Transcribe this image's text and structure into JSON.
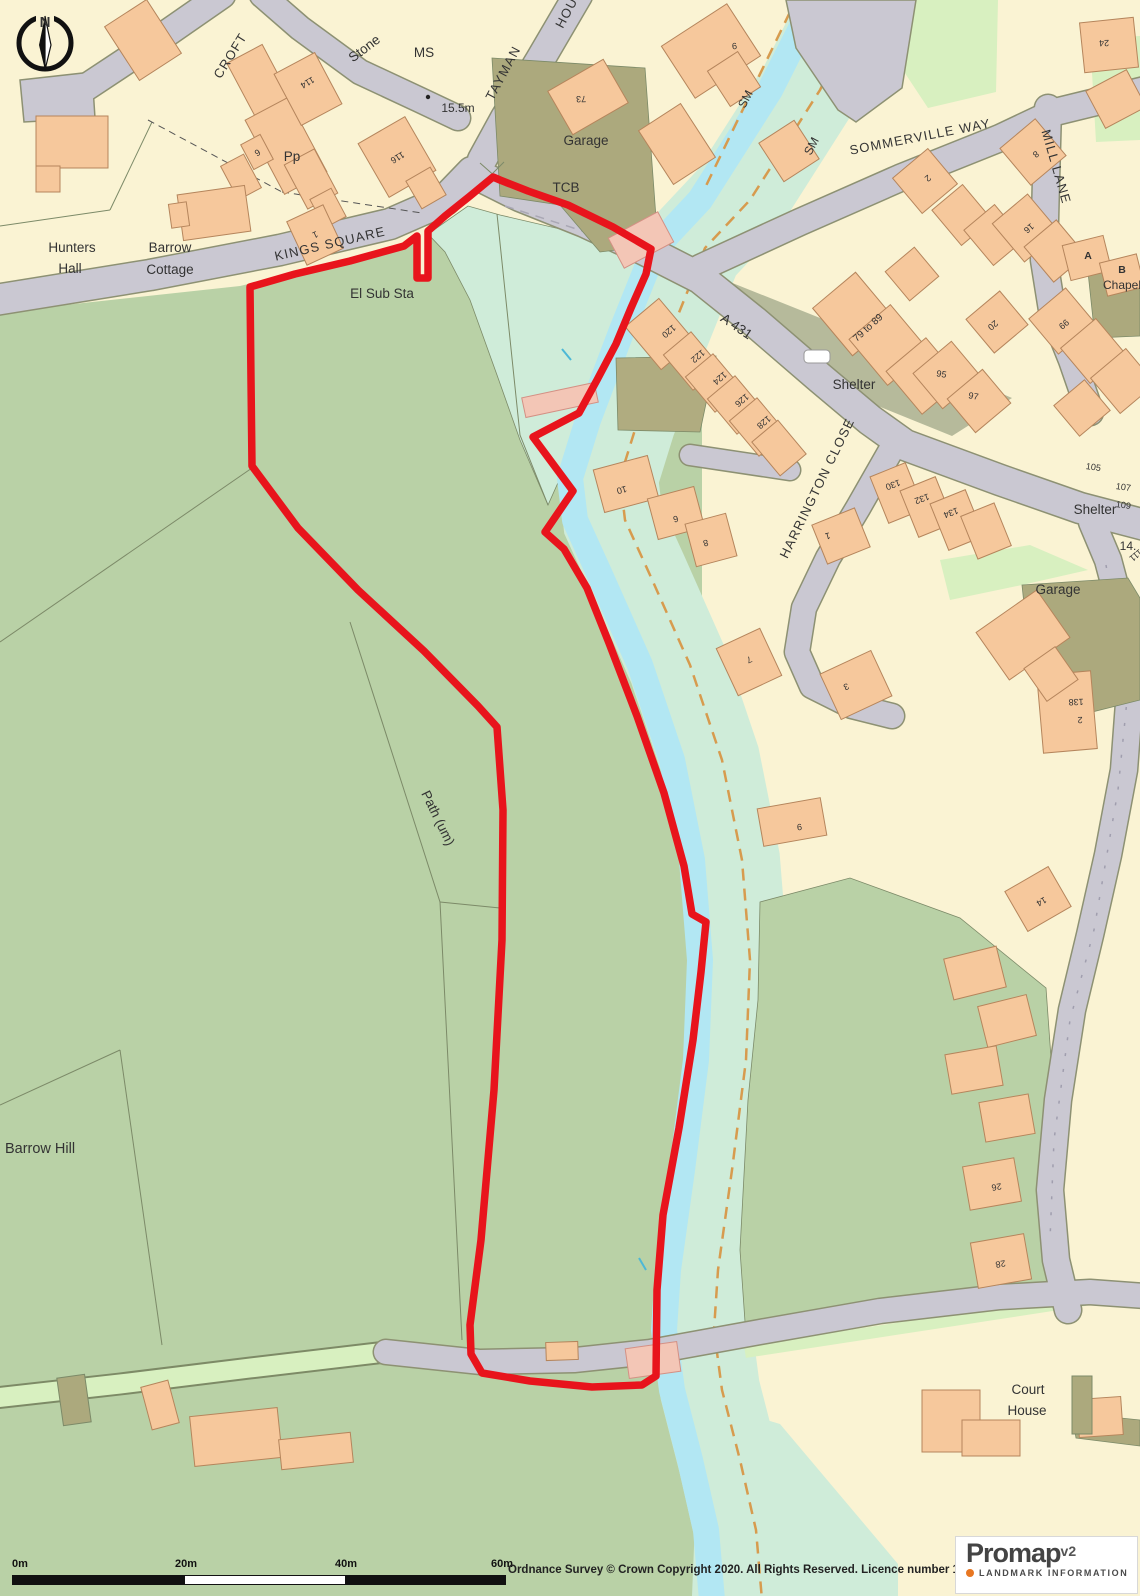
{
  "map": {
    "colors": {
      "cream": "#faf3d3",
      "field": "#b9d1a6",
      "mint": "#cfecd9",
      "verge": "#d8f0c0",
      "stream": "#b2e7f3",
      "road": "#cac8d2",
      "road_casing": "#8d9173",
      "khaki": "#aca97d",
      "khaki2": "#b6ba9b",
      "building": "#f6c89c",
      "building_stroke": "#b5855c",
      "pink": "#f3c6b6",
      "pink_stroke": "#d49084",
      "boundary": "#e8141c",
      "parcel": "#7c8a68",
      "dashed_orange": "#d79b4e",
      "label": "#333333",
      "number": "#444444"
    },
    "labels": [
      {
        "t": "CROFT",
        "x": 234,
        "y": 58,
        "r": -58,
        "c": "road"
      },
      {
        "t": "Stone",
        "x": 367,
        "y": 52,
        "r": -37,
        "c": "place"
      },
      {
        "t": "MS",
        "x": 424,
        "y": 57,
        "r": 0,
        "c": "place"
      },
      {
        "t": "15.5m",
        "x": 458,
        "y": 112,
        "r": 0,
        "c": "place",
        "s": 12
      },
      {
        "t": "TAYMAN",
        "x": 507,
        "y": 75,
        "r": -62,
        "c": "road"
      },
      {
        "t": "HOUSE",
        "x": 575,
        "y": 6,
        "r": -62,
        "c": "road"
      },
      {
        "t": "Garage",
        "x": 586,
        "y": 145,
        "r": 0,
        "c": "place"
      },
      {
        "t": "TCB",
        "x": 566,
        "y": 192,
        "r": 0,
        "c": "place"
      },
      {
        "t": "SM",
        "x": 749,
        "y": 101,
        "r": -62,
        "c": "place",
        "s": 12
      },
      {
        "t": "SM",
        "x": 815,
        "y": 148,
        "r": -62,
        "c": "place",
        "s": 12
      },
      {
        "t": "SOMMERVILLE WAY",
        "x": 921,
        "y": 141,
        "r": -11,
        "c": "road"
      },
      {
        "t": "MILL LANE",
        "x": 1052,
        "y": 168,
        "r": 74,
        "c": "road"
      },
      {
        "t": "KINGS SQUARE",
        "x": 331,
        "y": 248,
        "r": -13,
        "c": "road"
      },
      {
        "t": "Hunters",
        "x": 72,
        "y": 252,
        "r": 0,
        "c": "place"
      },
      {
        "t": "Hall",
        "x": 70,
        "y": 273,
        "r": 0,
        "c": "place"
      },
      {
        "t": "Barrow",
        "x": 170,
        "y": 252,
        "r": 0,
        "c": "place"
      },
      {
        "t": "Cottage",
        "x": 170,
        "y": 274,
        "r": 0,
        "c": "place"
      },
      {
        "t": "Pp",
        "x": 292,
        "y": 161,
        "r": 0,
        "c": "place"
      },
      {
        "t": "El Sub Sta",
        "x": 382,
        "y": 298,
        "r": 0,
        "c": "place"
      },
      {
        "t": "A 431",
        "x": 734,
        "y": 330,
        "r": 34,
        "c": "place"
      },
      {
        "t": "Shelter",
        "x": 854,
        "y": 389,
        "r": 0,
        "c": "place"
      },
      {
        "t": "HARRINGTON CLOSE",
        "x": 821,
        "y": 490,
        "r": -64,
        "c": "road"
      },
      {
        "t": "Shelter",
        "x": 1095,
        "y": 514,
        "r": 0,
        "c": "place"
      },
      {
        "t": "14.",
        "x": 1128,
        "y": 550,
        "r": 0,
        "c": "place",
        "s": 12
      },
      {
        "t": "Garage",
        "x": 1058,
        "y": 594,
        "r": 0,
        "c": "place"
      },
      {
        "t": "Chapel",
        "x": 1122,
        "y": 289,
        "r": 0,
        "c": "place",
        "s": 12
      },
      {
        "t": "Path (um)",
        "x": 434,
        "y": 820,
        "r": 64,
        "c": "place"
      },
      {
        "t": "Barrow Hill",
        "x": 40,
        "y": 1153,
        "r": 0,
        "c": "place",
        "s": 14.5
      },
      {
        "t": "Court",
        "x": 1028,
        "y": 1394,
        "r": 0,
        "c": "place"
      },
      {
        "t": "House",
        "x": 1027,
        "y": 1415,
        "r": 0,
        "c": "place"
      },
      {
        "t": "79 to 89",
        "x": 870,
        "y": 330,
        "r": -42,
        "c": "num",
        "s": 10
      }
    ],
    "house_numbers": [
      {
        "t": "114",
        "x": 306,
        "y": 80,
        "r": 150
      },
      {
        "t": "116",
        "x": 396,
        "y": 155,
        "r": 148
      },
      {
        "t": "6",
        "x": 256,
        "y": 150,
        "r": 150
      },
      {
        "t": "1",
        "x": 314,
        "y": 232,
        "r": 155
      },
      {
        "t": "73",
        "x": 581,
        "y": 96,
        "r": 178
      },
      {
        "t": "9",
        "x": 734,
        "y": 43,
        "r": 172
      },
      {
        "t": "24",
        "x": 1104,
        "y": 40,
        "r": 178
      },
      {
        "t": "2",
        "x": 926,
        "y": 176,
        "r": 140
      },
      {
        "t": "8",
        "x": 1034,
        "y": 152,
        "r": 140
      },
      {
        "t": "16",
        "x": 1027,
        "y": 226,
        "r": 140
      },
      {
        "t": "A",
        "x": 1088,
        "y": 259,
        "r": 0,
        "c": "letter"
      },
      {
        "t": "B",
        "x": 1122,
        "y": 273,
        "r": 0,
        "c": "letter"
      },
      {
        "t": "99",
        "x": 1062,
        "y": 322,
        "r": 140
      },
      {
        "t": "20",
        "x": 991,
        "y": 323,
        "r": 140
      },
      {
        "t": "95",
        "x": 941,
        "y": 377,
        "r": 10
      },
      {
        "t": "97",
        "x": 973,
        "y": 399,
        "r": 10
      },
      {
        "t": "105",
        "x": 1093,
        "y": 470,
        "r": 8
      },
      {
        "t": "107",
        "x": 1123,
        "y": 490,
        "r": 8
      },
      {
        "t": "109",
        "x": 1123,
        "y": 508,
        "r": 8
      },
      {
        "t": "111",
        "x": 1134,
        "y": 553,
        "r": 140
      },
      {
        "t": "120",
        "x": 667,
        "y": 329,
        "r": 140
      },
      {
        "t": "122",
        "x": 696,
        "y": 354,
        "r": 140
      },
      {
        "t": "124",
        "x": 718,
        "y": 376,
        "r": 140
      },
      {
        "t": "126",
        "x": 740,
        "y": 398,
        "r": 140
      },
      {
        "t": "128",
        "x": 762,
        "y": 420,
        "r": 140
      },
      {
        "t": "130",
        "x": 892,
        "y": 482,
        "r": 160
      },
      {
        "t": "132",
        "x": 921,
        "y": 496,
        "r": 160
      },
      {
        "t": "134",
        "x": 950,
        "y": 510,
        "r": 160
      },
      {
        "t": "1",
        "x": 827,
        "y": 533,
        "r": 165
      },
      {
        "t": "10",
        "x": 621,
        "y": 487,
        "r": 165
      },
      {
        "t": "6",
        "x": 675,
        "y": 516,
        "r": 165
      },
      {
        "t": "8",
        "x": 705,
        "y": 540,
        "r": 165
      },
      {
        "t": "7",
        "x": 748,
        "y": 657,
        "r": 155
      },
      {
        "t": "3",
        "x": 845,
        "y": 684,
        "r": 155
      },
      {
        "t": "9",
        "x": 799,
        "y": 824,
        "r": 172
      },
      {
        "t": "138",
        "x": 1076,
        "y": 699,
        "r": 178
      },
      {
        "t": "2",
        "x": 1080,
        "y": 717,
        "r": 178
      },
      {
        "t": "14",
        "x": 1040,
        "y": 899,
        "r": 150
      },
      {
        "t": "26",
        "x": 996,
        "y": 1184,
        "r": 170
      },
      {
        "t": "28",
        "x": 1000,
        "y": 1261,
        "r": 170
      }
    ],
    "compass_north": "N",
    "scale_bar": {
      "ticks": [
        "0m",
        "20m",
        "40m",
        "60m"
      ]
    },
    "copyright": "Ordnance Survey © Crown Copyright 2020. All Rights Reserved. Licence number 100022432",
    "logo": {
      "brand": "Promap",
      "version": "v2",
      "tagline": "LANDMARK INFORMATION"
    }
  }
}
